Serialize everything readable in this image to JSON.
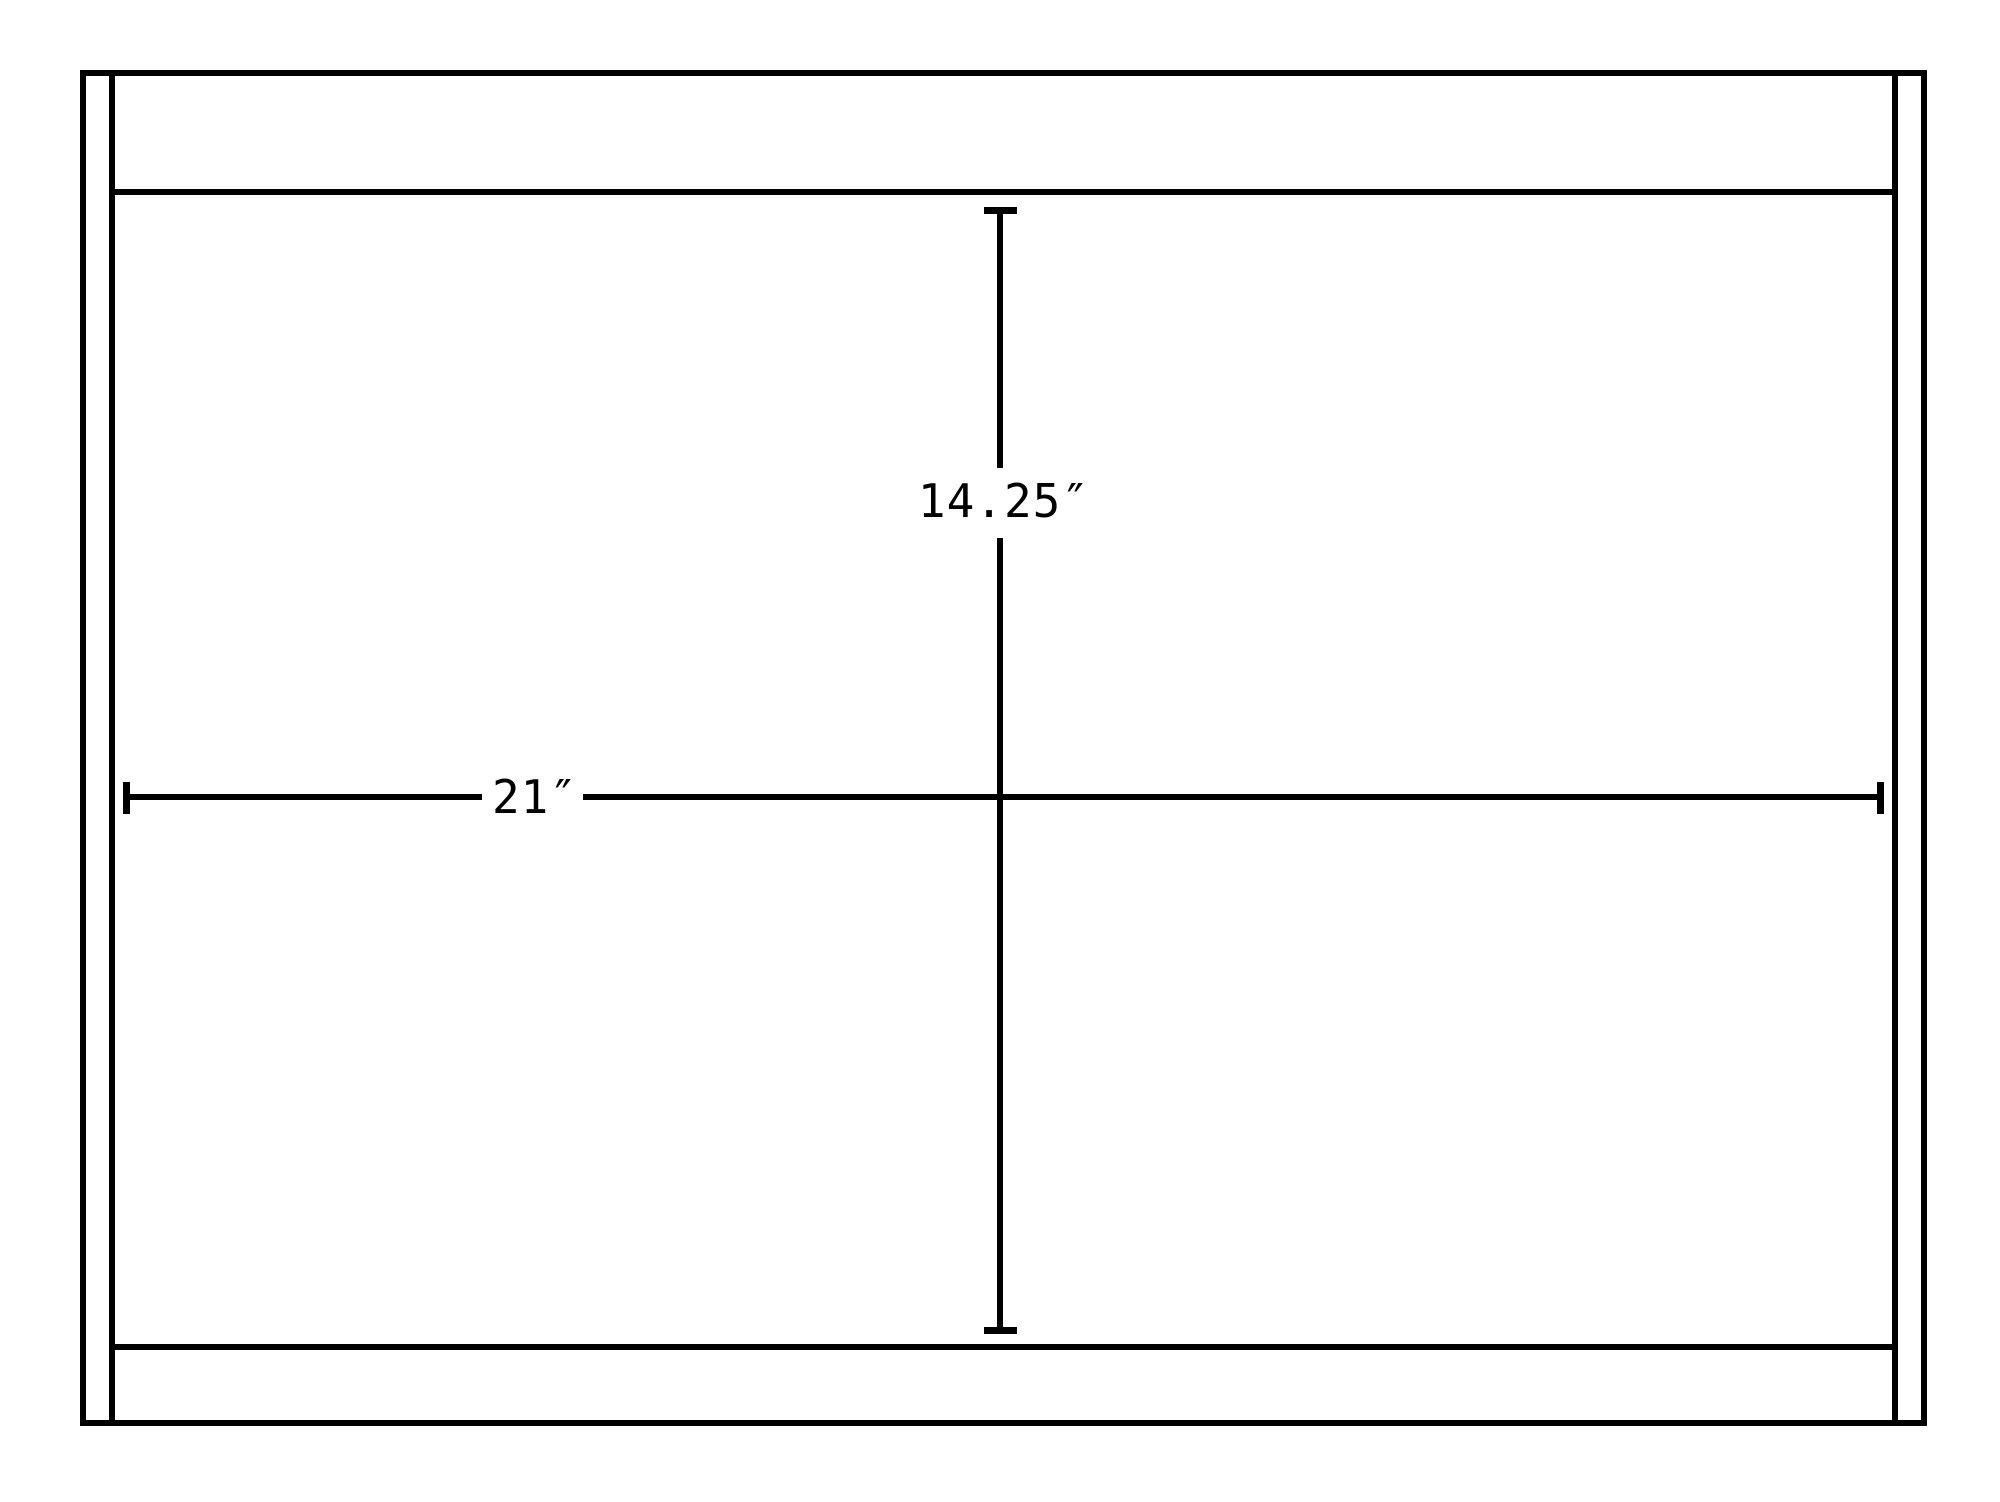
{
  "diagram": {
    "type": "technical-dimension-drawing",
    "colors": {
      "line": "#000000",
      "background": "#ffffff"
    },
    "dimensions": {
      "width_label": "21″",
      "height_label": "14.25″"
    }
  }
}
